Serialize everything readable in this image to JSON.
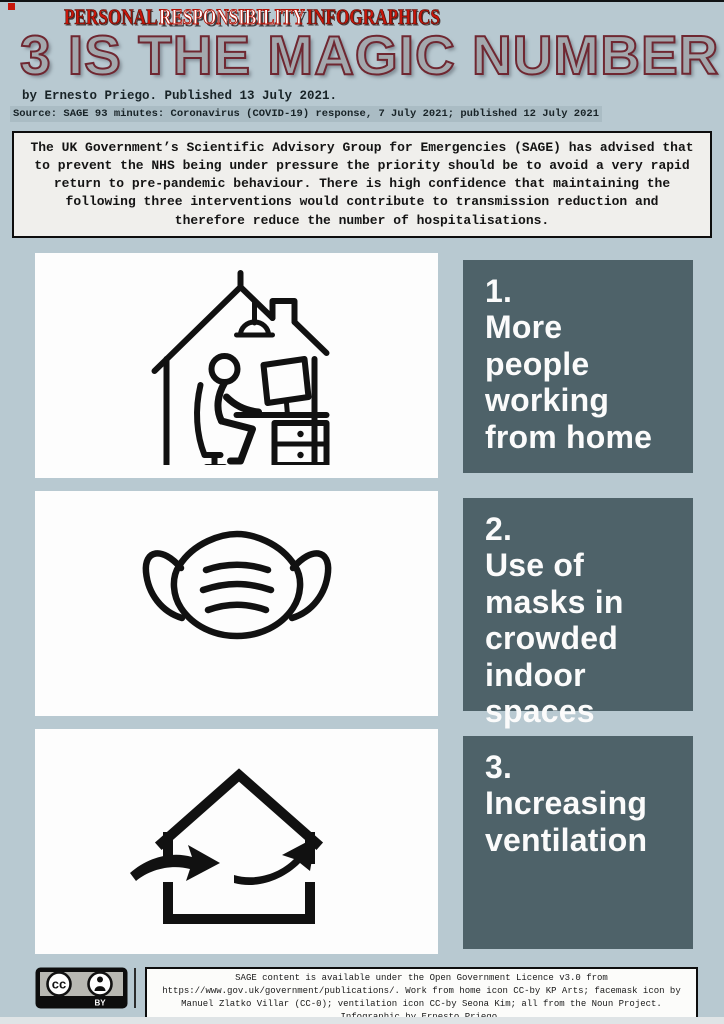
{
  "page": {
    "background_color": "#b8c9d1",
    "accent_red": "#c8170b",
    "panel_color": "#4e6269",
    "title_color": "#a3a8ad"
  },
  "header": {
    "kicker": {
      "word1": "PERSONAL",
      "word2": "RESPONSIBILITY",
      "word3": "INFOGRAPHICS"
    },
    "title": "3 IS THE MAGIC NUMBER",
    "byline": "by Ernesto Priego. Published 13 July 2021.",
    "source_line": "Source: SAGE 93 minutes: Coronavirus (COVID-19) response, 7 July 2021; published 12 July 2021"
  },
  "intro": {
    "text": "The UK Government’s Scientific Advisory Group for Emergencies (SAGE) has advised that to prevent the NHS being under pressure the priority should be to avoid a very rapid return to pre-pandemic behaviour. There is high confidence that maintaining the following three interventions would contribute to transmission reduction and therefore reduce the number of hospitalisations."
  },
  "sections": [
    {
      "number": "1.",
      "label": "More people working from home",
      "icon": "work-from-home-icon"
    },
    {
      "number": "2.",
      "label": "Use of masks in crowded indoor spaces",
      "icon": "face-mask-icon"
    },
    {
      "number": "3.",
      "label": "Increasing ventilation",
      "icon": "ventilation-icon"
    }
  ],
  "footer": {
    "badge": {
      "cc": "cc",
      "by": "BY"
    },
    "credits": "SAGE content is available under the Open Government Licence v3.0 from https://www.gov.uk/government/publications/. Work from home icon CC-by KP Arts; facemask icon by Manuel Zlatko Villar (CC-0); ventilation icon CC-by Seona Kim; all from the Noun Project. Infographic by Ernesto Priego."
  }
}
